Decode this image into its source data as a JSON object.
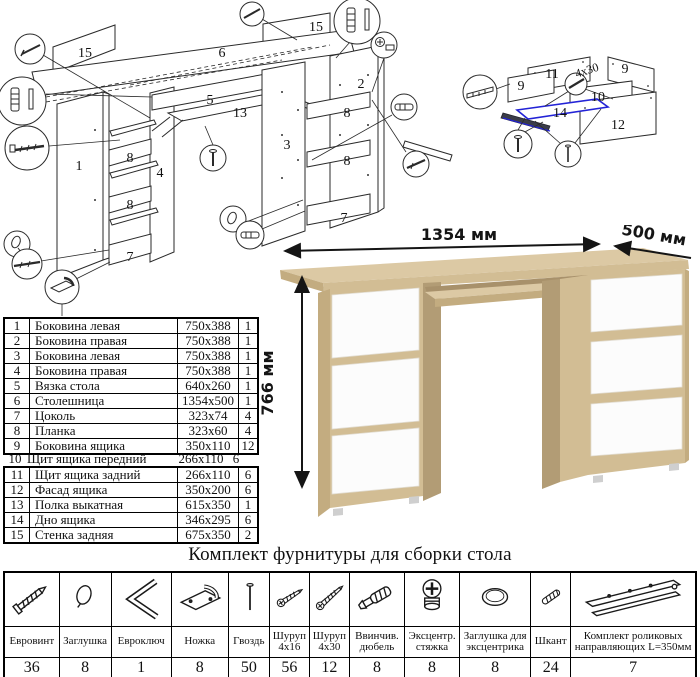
{
  "exploded_diagram": {
    "description": "Схема сборки стола (взрыв-схема)",
    "part_labels": [
      "15",
      "6",
      "15",
      "5",
      "13",
      "1",
      "4",
      "8",
      "8",
      "7",
      "2",
      "3",
      "8",
      "8",
      "7"
    ]
  },
  "drawer_diagram": {
    "description": "Схема сборки ящика",
    "part_labels": [
      "11",
      "9",
      "9",
      "10",
      "14",
      "12"
    ],
    "screw_size_note": "4x30",
    "highlight_color": "#2323d6"
  },
  "desk_render": {
    "width_label": "1354 мм",
    "depth_label": "500 мм",
    "height_label": "766 мм",
    "colors": {
      "oak_top": "#dcc9a4",
      "oak_front": "#d2bd94",
      "oak_side": "#c3ac80",
      "oak_inner": "#b29c75",
      "drawer_white": "#fcfcfc"
    }
  },
  "parts_table": {
    "rows": [
      {
        "num": "1",
        "name": "Боковина левая",
        "size": "750x388",
        "qty": "1"
      },
      {
        "num": "2",
        "name": "Боковина правая",
        "size": "750x388",
        "qty": "1"
      },
      {
        "num": "3",
        "name": "Боковина левая",
        "size": "750x388",
        "qty": "1"
      },
      {
        "num": "4",
        "name": "Боковина правая",
        "size": "750x388",
        "qty": "1"
      },
      {
        "num": "5",
        "name": "Вязка стола",
        "size": "640x260",
        "qty": "1"
      },
      {
        "num": "6",
        "name": "Столешница",
        "size": "1354x500",
        "qty": "1"
      },
      {
        "num": "7",
        "name": "Цоколь",
        "size": "323x74",
        "qty": "4"
      },
      {
        "num": "8",
        "name": "Планка",
        "size": "323x60",
        "qty": "4"
      },
      {
        "num": "9",
        "name": "Боковина ящика",
        "size": "350x110",
        "qty": "12"
      },
      {
        "num": "10",
        "name": "Щит ящика передний",
        "size": "266x110",
        "qty": "6"
      },
      {
        "num": "11",
        "name": "Щит ящика задний",
        "size": "266x110",
        "qty": "6"
      },
      {
        "num": "12",
        "name": "Фасад ящика",
        "size": "350x200",
        "qty": "6"
      },
      {
        "num": "13",
        "name": "Полка выкатная",
        "size": "615x350",
        "qty": "1"
      },
      {
        "num": "14",
        "name": "Дно ящика",
        "size": "346x295",
        "qty": "6"
      },
      {
        "num": "15",
        "name": "Стенка задняя",
        "size": "675x350",
        "qty": "2"
      }
    ]
  },
  "hardware_kit": {
    "title": "Комплект фурнитуры для сборки стола",
    "items": [
      {
        "icon": "confirmat-screw-icon",
        "name": "Евровинт",
        "qty": "36"
      },
      {
        "icon": "screw-cap-icon",
        "name": "Заглушка",
        "qty": "8"
      },
      {
        "icon": "hex-key-icon",
        "name": "Евроключ",
        "qty": "1"
      },
      {
        "icon": "furniture-foot-icon",
        "name": "Ножка",
        "qty": "8"
      },
      {
        "icon": "nail-icon",
        "name": "Гвоздь",
        "qty": "50"
      },
      {
        "icon": "screw-short-icon",
        "name": "Шуруп 4x16",
        "qty": "56"
      },
      {
        "icon": "screw-long-icon",
        "name": "Шуруп 4x30",
        "qty": "12"
      },
      {
        "icon": "dowel-screw-icon",
        "name": "Ввинчив. дюбель",
        "qty": "8"
      },
      {
        "icon": "cam-lock-icon",
        "name": "Эксцентр. стяжка",
        "qty": "8"
      },
      {
        "icon": "cam-cap-icon",
        "name": "Заглушка для эксцентрика",
        "qty": "8"
      },
      {
        "icon": "wood-dowel-icon",
        "name": "Шкант",
        "qty": "24"
      },
      {
        "icon": "drawer-slides-icon",
        "name": "Комплект роликовых направляющих L=350мм",
        "qty": "7"
      }
    ]
  }
}
